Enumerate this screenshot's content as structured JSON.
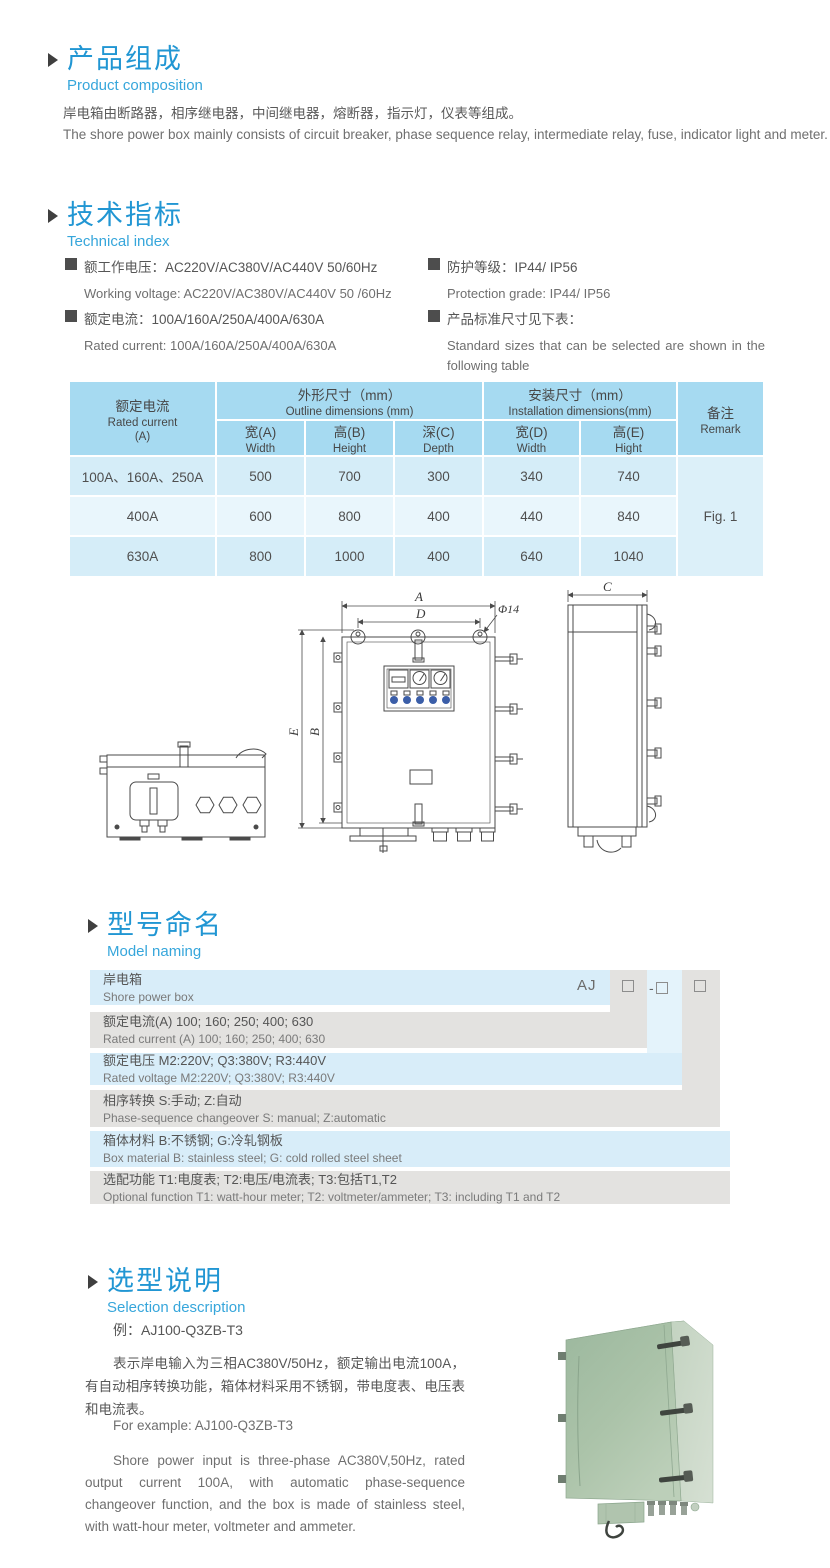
{
  "colors": {
    "accent_blue": "#2196d3",
    "subtitle_blue": "#36a6db",
    "table_header_bg": "#a6daf1",
    "table_row_light": "#d5edf8",
    "table_row_lighter": "#e9f6fc",
    "band_blue": "#d8edf9",
    "band_gray": "#e3e2e0",
    "indicator_blue": "#3b5ea8",
    "product_green": "#a9c2a7"
  },
  "sections": {
    "product_composition": {
      "title_zh": "产品组成",
      "title_en": "Product  composition",
      "body_zh": "岸电箱由断路器，相序继电器，中间继电器，熔断器，指示灯，仪表等组成。",
      "body_en": "The shore power box mainly consists of circuit breaker, phase sequence relay, intermediate relay, fuse, indicator light and meter."
    },
    "technical_index": {
      "title_zh": "技术指标",
      "title_en": "Technical index",
      "specs": [
        {
          "zh": "额工作电压：AC220V/AC380V/AC440V  50/60Hz",
          "en": "Working voltage: AC220V/AC380V/AC440V 50 /60Hz"
        },
        {
          "zh": "额定电流：100A/160A/250A/400A/630A",
          "en": "Rated current: 100A/160A/250A/400A/630A"
        },
        {
          "zh": "防护等级：IP44/ IP56",
          "en": "Protection grade: IP44/ IP56"
        },
        {
          "zh": "产品标准尺寸见下表：",
          "en": "Standard sizes that can be selected are shown in the following table"
        }
      ]
    },
    "model_naming": {
      "title_zh": "型号命名",
      "title_en": "Model naming"
    },
    "selection": {
      "title_zh": "选型说明",
      "title_en": "Selection description",
      "example_zh": "例：AJ100-Q3ZB-T3",
      "para_zh": "表示岸电输入为三相AC380V/50Hz，额定输出电流100A，有自动相序转换功能，箱体材料采用不锈钢，带电度表、电压表和电流表。",
      "example_en": "For example: AJ100-Q3ZB-T3",
      "para_en": "Shore power input is three-phase AC380V,50Hz, rated output current 100A, with automatic phase-sequence changeover function, and the box is made of stainless steel, with watt-hour meter, voltmeter and ammeter."
    }
  },
  "dimensions_table": {
    "col_rated_current": {
      "zh": "额定电流",
      "en": "Rated current",
      "unit": "(A)"
    },
    "group_outline": {
      "zh": "外形尺寸（mm）",
      "en": "Outline dimensions (mm)"
    },
    "group_install": {
      "zh": "安装尺寸（mm）",
      "en": "Installation dimensions(mm)"
    },
    "col_remark": {
      "zh": "备注",
      "en": "Remark"
    },
    "subcols": [
      {
        "zh": "宽(A)",
        "en": "Width"
      },
      {
        "zh": "高(B)",
        "en": "Height"
      },
      {
        "zh": "深(C)",
        "en": "Depth"
      },
      {
        "zh": "宽(D)",
        "en": "Width"
      },
      {
        "zh": "高(E)",
        "en": "Hight"
      }
    ],
    "rows": [
      {
        "current": "100A、160A、250A",
        "values": [
          "500",
          "700",
          "300",
          "340",
          "740"
        ]
      },
      {
        "current": "400A",
        "values": [
          "600",
          "800",
          "400",
          "440",
          "840"
        ]
      },
      {
        "current": "630A",
        "values": [
          "800",
          "1000",
          "400",
          "640",
          "1040"
        ]
      }
    ],
    "remark_value": "Fig. 1"
  },
  "model_naming_table": {
    "prefix": "AJ",
    "dash": "-",
    "rows": [
      {
        "zh": "岸电箱",
        "en": "Shore power box"
      },
      {
        "zh": "额定电流(A)  100; 160; 250; 400; 630",
        "en": "Rated current (A) 100; 160; 250; 400; 630"
      },
      {
        "zh": "额定电压   M2:220V;  Q3:380V;  R3:440V",
        "en": "Rated voltage  M2:220V;  Q3:380V;  R3:440V"
      },
      {
        "zh": "相序转换  S:手动; Z:自动",
        "en": "Phase-sequence changeover  S: manual;  Z:automatic"
      },
      {
        "zh": "箱体材料    B:不锈钢;  G:冷轧钢板",
        "en": "Box material    B: stainless steel; G: cold rolled steel sheet"
      },
      {
        "zh": "选配功能      T1:电度表;  T2:电压/电流表; T3:包括T1,T2",
        "en": "Optional function  T1: watt-hour meter; T2: voltmeter/ammeter; T3: including T1 and T2"
      }
    ]
  },
  "drawing": {
    "labels": {
      "width_a": "A",
      "hole_pitch_d": "D",
      "hole_dia": "Φ14",
      "overall_height_e": "E",
      "body_height_b": "B",
      "depth_c": "C"
    }
  }
}
